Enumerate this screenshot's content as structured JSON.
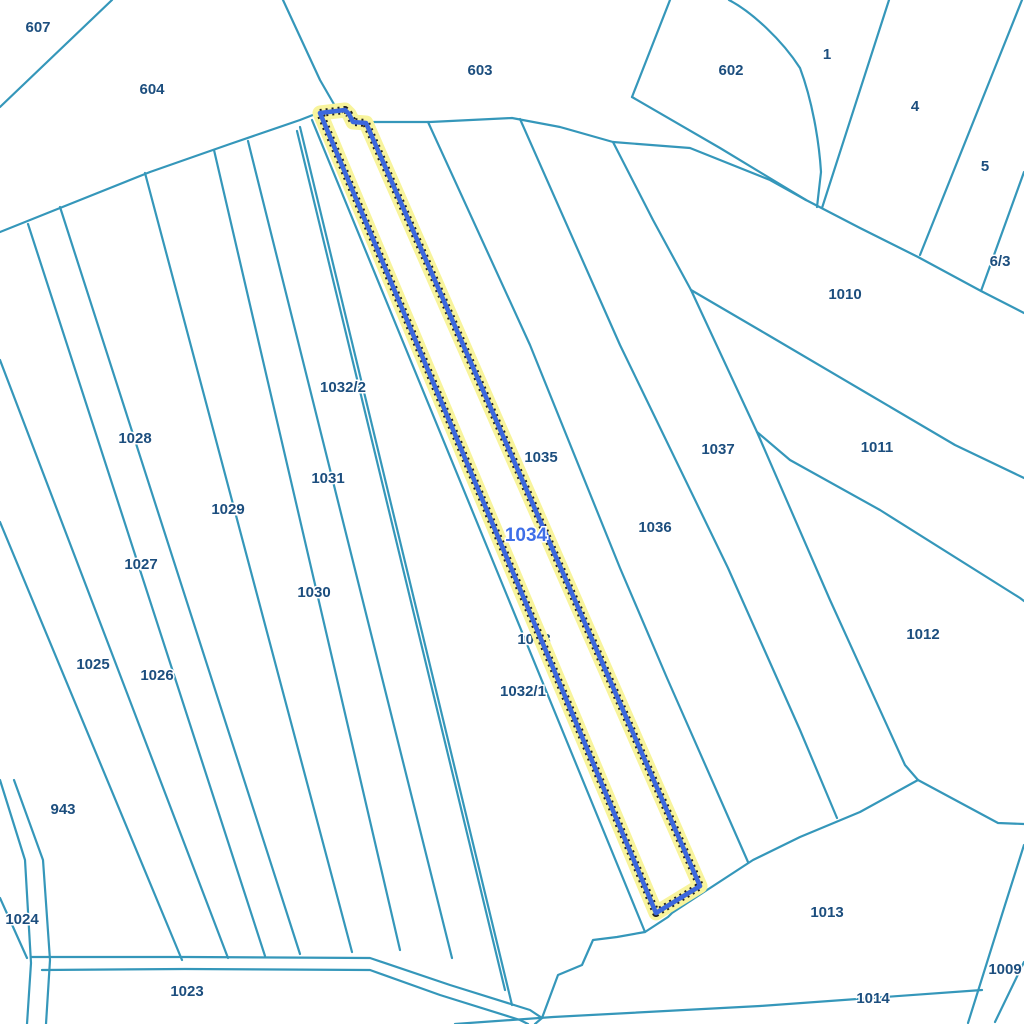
{
  "map": {
    "type": "cadastral-parcel-map",
    "background_color": "#ffffff",
    "boundary_color": "#3597ba",
    "label_color": "#1c4e7e",
    "selected_parcel": {
      "id": "1034",
      "outline_color": "#3c68dd",
      "halo_color": "#f8f49c",
      "label_color": "#3f6fe8"
    },
    "labels": [
      {
        "text": "607",
        "x": 38,
        "y": 28,
        "layer": "over"
      },
      {
        "text": "604",
        "x": 152,
        "y": 90,
        "layer": "over"
      },
      {
        "text": "603",
        "x": 480,
        "y": 71,
        "layer": "over"
      },
      {
        "text": "602",
        "x": 731,
        "y": 71,
        "layer": "over"
      },
      {
        "text": "1",
        "x": 827,
        "y": 55,
        "layer": "over"
      },
      {
        "text": "4",
        "x": 915,
        "y": 107,
        "layer": "over"
      },
      {
        "text": "5",
        "x": 985,
        "y": 167,
        "layer": "over"
      },
      {
        "text": "6/3",
        "x": 1000,
        "y": 262,
        "layer": "over"
      },
      {
        "text": "1010",
        "x": 845,
        "y": 295,
        "layer": "over"
      },
      {
        "text": "1011",
        "x": 877,
        "y": 448,
        "layer": "over"
      },
      {
        "text": "1037",
        "x": 718,
        "y": 450,
        "layer": "over"
      },
      {
        "text": "1028",
        "x": 135,
        "y": 439,
        "layer": "over"
      },
      {
        "text": "1032/2",
        "x": 343,
        "y": 388,
        "layer": "over"
      },
      {
        "text": "1035",
        "x": 541,
        "y": 458,
        "layer": "over"
      },
      {
        "text": "1031",
        "x": 328,
        "y": 479,
        "layer": "over"
      },
      {
        "text": "1029",
        "x": 228,
        "y": 510,
        "layer": "over"
      },
      {
        "text": "1036",
        "x": 655,
        "y": 528,
        "layer": "over"
      },
      {
        "text": "1027",
        "x": 141,
        "y": 565,
        "layer": "over"
      },
      {
        "text": "1030",
        "x": 314,
        "y": 593,
        "layer": "over"
      },
      {
        "text": "1012",
        "x": 923,
        "y": 635,
        "layer": "over"
      },
      {
        "text": "1033",
        "x": 534,
        "y": 640,
        "layer": "under"
      },
      {
        "text": "1025",
        "x": 93,
        "y": 665,
        "layer": "over"
      },
      {
        "text": "1026",
        "x": 157,
        "y": 676,
        "layer": "over"
      },
      {
        "text": "1032/1",
        "x": 523,
        "y": 692,
        "layer": "over"
      },
      {
        "text": "943",
        "x": 63,
        "y": 810,
        "layer": "over"
      },
      {
        "text": "1013",
        "x": 827,
        "y": 913,
        "layer": "over"
      },
      {
        "text": "1024",
        "x": 22,
        "y": 920,
        "layer": "over"
      },
      {
        "text": "1009",
        "x": 1005,
        "y": 970,
        "layer": "over"
      },
      {
        "text": "1023",
        "x": 187,
        "y": 992,
        "layer": "over"
      },
      {
        "text": "1014",
        "x": 873,
        "y": 999,
        "layer": "over"
      },
      {
        "text": "1034",
        "x": 526,
        "y": 536,
        "layer": "selected"
      }
    ]
  }
}
